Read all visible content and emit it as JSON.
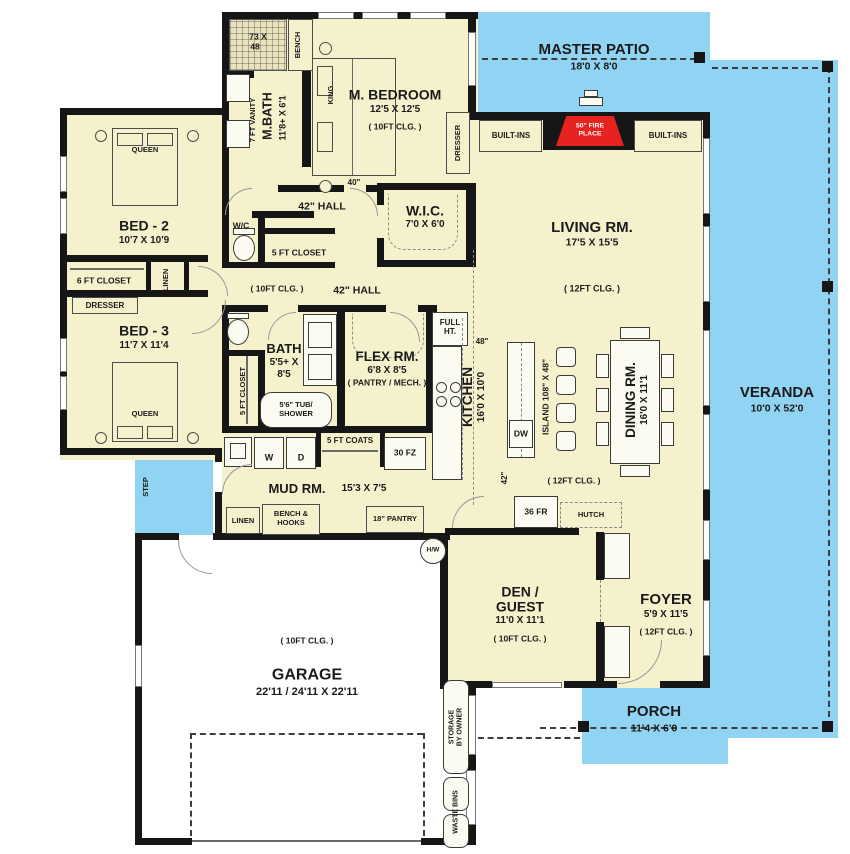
{
  "outdoor": {
    "master_patio": {
      "name": "MASTER PATIO",
      "dims": "18'0 X 8'0"
    },
    "veranda": {
      "name": "VERANDA",
      "dims": "10'0 X 52'0"
    },
    "porch": {
      "name": "PORCH",
      "dims": "11'4 X 6'0"
    },
    "step": "STEP"
  },
  "shared": {
    "clg10": "( 10FT CLG. )",
    "clg12": "( 12FT CLG. )",
    "queen": "QUEEN",
    "dresser": "DRESSER",
    "linen": "LINEN",
    "wc": "W/C",
    "closet5": "5 FT CLOSET",
    "hall42": "42\" HALL",
    "dim40": "40\"",
    "dim48": "48\"",
    "dim42": "42\"",
    "builtins": "BUILT-INS"
  },
  "master_suite": {
    "bedroom": {
      "name": "M. BEDROOM",
      "dims": "12'5 X 12'5",
      "bed": "KING"
    },
    "bath": {
      "name": "M.BATH",
      "dims": "11'8+ X 6'1",
      "vanity": "7 FT VANITY",
      "shower_l1": "73 X",
      "shower_l2": "48",
      "bench": "BENCH"
    },
    "wic": {
      "name": "W.I.C.",
      "dims": "7'0 X 6'0"
    }
  },
  "bed2": {
    "name": "BED - 2",
    "dims": "10'7 X 10'9",
    "closet": "6 FT CLOSET"
  },
  "bed3": {
    "name": "BED - 3",
    "dims": "11'7 X 11'4"
  },
  "bath2": {
    "name": "BATH",
    "dims_l1": "5'5+ X",
    "dims_l2": "8'5",
    "tub_l1": "5'6\" TUB/",
    "tub_l2": "SHOWER"
  },
  "flex": {
    "name": "FLEX RM.",
    "dims": "6'8 X 8'5",
    "note": "( PANTRY / MECH. )"
  },
  "living": {
    "name": "LIVING RM.",
    "dims": "17'5 X 15'5",
    "fireplace_l1": "50\" FIRE",
    "fireplace_l2": "PLACE"
  },
  "kitchen": {
    "name": "KITCHEN",
    "dims": "16'0 X 10'0",
    "island": "ISLAND 108\" X 48\"",
    "dw": "DW",
    "full_l1": "FULL",
    "full_l2": "HT.",
    "fridge": "36 FR"
  },
  "dining": {
    "name": "DINING RM.",
    "dims": "16'0 X 11'1",
    "hutch": "HUTCH"
  },
  "mud": {
    "name": "MUD RM.",
    "dims": "15'3 X 7'5",
    "washer": "W",
    "dryer": "D",
    "coats": "5 FT COATS",
    "freezer": "30 FZ",
    "bench_l1": "BENCH &",
    "bench_l2": "HOOKS",
    "pantry": "18\" PANTRY",
    "hw": "H/W"
  },
  "den": {
    "name_l1": "DEN /",
    "name_l2": "GUEST",
    "dims": "11'0 X 11'1"
  },
  "foyer": {
    "name": "FOYER",
    "dims": "5'9 X 11'5"
  },
  "garage": {
    "name": "GARAGE",
    "dims": "22'11 / 24'11 X 22'11",
    "storage_l1": "STORAGE",
    "storage_l2": "BY OWNER",
    "waste": "WASTE BINS"
  },
  "colors": {
    "floor": "#f6f1cd",
    "outdoor": "#90d3f2",
    "wall": "#161616",
    "fireplace_red": "#e62320"
  }
}
